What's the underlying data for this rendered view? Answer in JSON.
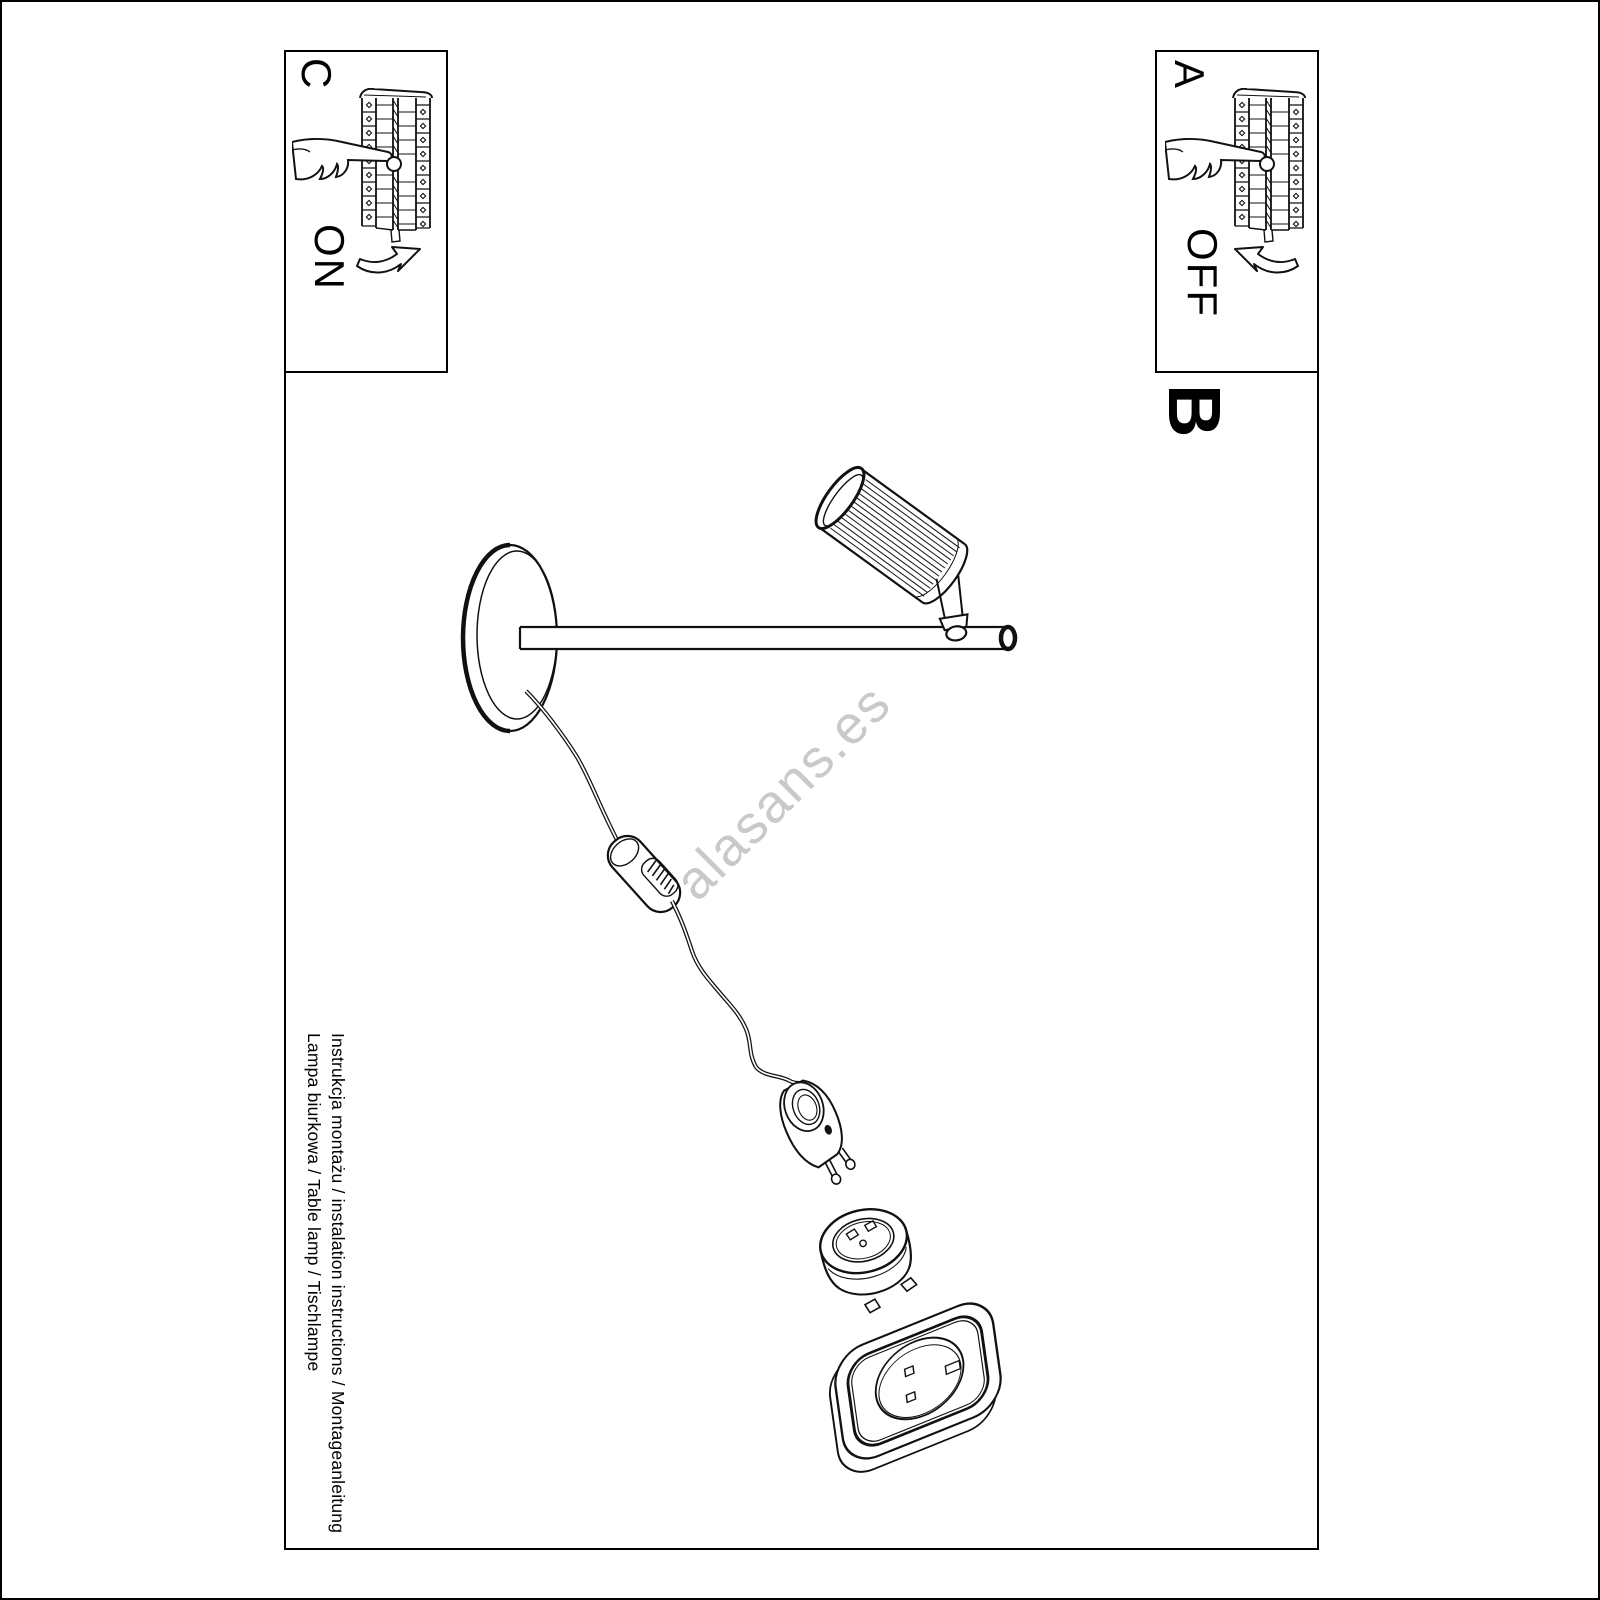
{
  "page": {
    "watermark": "alasans.es",
    "captions": {
      "line1": "Instrukcja montażu / instalation instructions / Montageanleitung",
      "line2": "Lampa biurkowa / Table lamp / Tischlampe"
    }
  },
  "sections": {
    "c": {
      "label": "C",
      "action": "ON"
    },
    "a": {
      "label": "A",
      "action": "OFF"
    },
    "b": {
      "label": "B"
    }
  },
  "illustrations": {
    "corner_boxes": "hand-pressing-switch-on-ribbed-lamp-shade",
    "main": "table-lamp-with-round-base-rod-ribbed-shade-cable-inline-switch-euro-plug-adapter-and-wall-socket"
  },
  "colors": {
    "line": "#000000",
    "background": "#ffffff",
    "watermark": "#c9c9c9"
  }
}
